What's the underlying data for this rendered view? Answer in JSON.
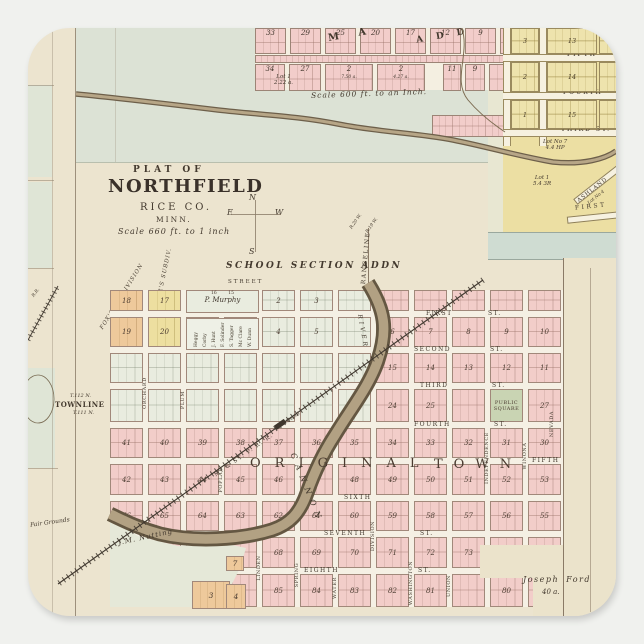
{
  "palette": {
    "pink": "#f2cdc9",
    "green": "#e9ecdf",
    "yellow": "#eddfa0",
    "yellow2": "#ecdfa3",
    "orange": "#eec99b",
    "square": "#c9d4b3",
    "river_dark": "#645742",
    "river_light": "#b2a183",
    "band_blue": "#cfdcd2",
    "ink": "#43392e"
  },
  "title_block": {
    "kicker": "PLAT OF",
    "title": "NORTHFIELD",
    "county": "RICE CO.",
    "state": "MINN.",
    "scale": "Scale 660 ft. to 1 inch"
  },
  "compass": {
    "n": "N",
    "e": "E",
    "w": "W",
    "s": "S"
  },
  "north_plat": {
    "letters_a": "M A",
    "letters_b": "A D D",
    "scale_note": "Scale 600 ft. to an Inch.",
    "row1": [
      "33",
      "29",
      "25",
      "20",
      "17",
      "12",
      "9",
      "3"
    ],
    "row2": [
      {
        "n": "34",
        "sub": ""
      },
      {
        "n": "27",
        "sub": ""
      },
      {
        "n": "2",
        "sub": "7.50 a."
      },
      {
        "n": "2",
        "sub": "4.27 a."
      },
      {
        "n": "11",
        "sub": ""
      },
      {
        "n": "9",
        "sub": ""
      },
      {
        "n": "2",
        "sub": ""
      }
    ],
    "lot": "Lot 1",
    "lot_sub": "2.22 a."
  },
  "east_plat": {
    "streets": [
      "FIFTH",
      "FOURTH",
      "THIRD  ST."
    ],
    "col_a": [
      "3",
      "2",
      "1"
    ],
    "col_b": [
      "13",
      "14",
      "15"
    ],
    "lot_a": "Lot No 7",
    "lot_a2": "4.4 HP",
    "lot_b": "Lot 1",
    "lot_b2": "5.4 3R",
    "ashland": "ASHLAND",
    "ashland2": "Lot No 4",
    "first": "FIRST"
  },
  "left_strip": {
    "rr": "R.R.",
    "townline": "TOWNLINE",
    "t_n": "T.112 N.",
    "t_s": "T.111 N.",
    "fair": "Fair Grounds"
  },
  "main_plat": {
    "school_add": "SCHOOL SECTION ADDN",
    "street": "STREET",
    "fox": "FOX'S SUBDIVISION",
    "wheeler": "WHEELER'S SUBDIV.",
    "rangeline": "RANGELINE",
    "r_w": "R.20 W.",
    "r_e": "R.19 W.",
    "murphy_nums": "16        15",
    "murphy": "P. Murphy",
    "owners": [
      "Heggy",
      "Corby",
      "J. Hunt",
      "F. Solinder",
      "S. Tagger",
      "Mc Clare",
      "W. Dunn"
    ],
    "h_streets": [
      "FIRST",
      "SECOND",
      "THIRD",
      "FOURTH",
      "FIFTH",
      "SIXTH",
      "SEVENTH",
      "EIGHTH"
    ],
    "st_suffix": "ST.",
    "v_streets": [
      "ORCHARD",
      "PLUM",
      "POPLAR",
      "LINDEN",
      "SPRING",
      "WATER",
      "DIVISION",
      "WASHINGTON",
      "UNION",
      "INDEPENDENCE",
      "WINONA",
      "NEVADA"
    ],
    "original_a": "ORIGINAL",
    "original_b": "TOWN",
    "public_square": "PUBLIC SQUARE",
    "cannon": "CANNON",
    "river": "RIVER",
    "railroad": "M. & ST. P. R. R.",
    "depot": "Depot",
    "nutting": "J.M. Nutting",
    "ford": "Joseph Ford",
    "ford_acres": "40 a.",
    "block_rows": [
      [
        "18",
        "17",
        "",
        "",
        "2",
        "3",
        "",
        "",
        "",
        "",
        "",
        ""
      ],
      [
        "19",
        "20",
        "",
        "",
        "4",
        "5",
        "",
        "6",
        "7",
        "8",
        "9",
        "10"
      ],
      [
        "",
        "",
        "",
        "",
        "",
        "",
        "",
        "15",
        "14",
        "13",
        "12",
        "11"
      ],
      [
        "",
        "",
        "",
        "",
        "",
        "",
        "",
        "24",
        "25",
        "",
        "26",
        "27"
      ],
      [
        "41",
        "40",
        "39",
        "38",
        "37",
        "36",
        "35",
        "34",
        "33",
        "32",
        "31",
        "30"
      ],
      [
        "42",
        "43",
        "44",
        "45",
        "46",
        "47",
        "48",
        "49",
        "50",
        "51",
        "52",
        "53"
      ],
      [
        "66",
        "65",
        "64",
        "63",
        "62",
        "61",
        "60",
        "59",
        "58",
        "57",
        "56",
        "55"
      ],
      [
        "",
        "",
        "",
        "67",
        "68",
        "69",
        "70",
        "71",
        "72",
        "73",
        "",
        ""
      ],
      [
        "",
        "",
        "",
        "86",
        "85",
        "84",
        "83",
        "82",
        "81",
        "",
        "80",
        ""
      ]
    ]
  }
}
